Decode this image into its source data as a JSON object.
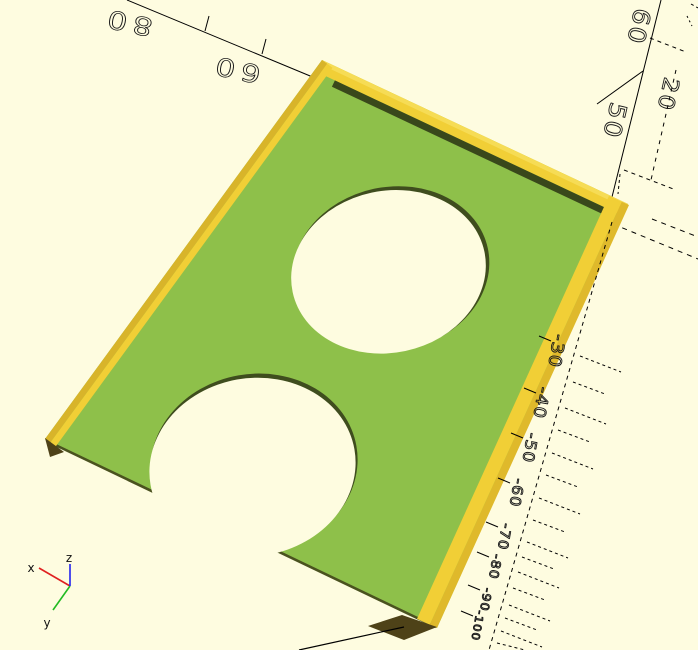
{
  "colors": {
    "background": "#FEFCE0",
    "plate_top": "#8EC04A",
    "wall_top_yellow": "#F1CF36",
    "wall_light_yellow": "#F6DC55",
    "wall_dark_yellow": "#DFB92B",
    "wall_dark_yellow2": "#D8B42A",
    "groove_dark": "#39481B",
    "edge_dark": "#4A521F",
    "hole_rim_dark": "#3F4D1E",
    "end_face_dark": "#4E4218",
    "axis_line": "#000000",
    "nav_x_red": "#E02020",
    "nav_y_green": "#22BB22",
    "nav_z_blue": "#2222EE"
  },
  "axis_labels": {
    "x_axis": [
      {
        "text": "80",
        "x": 129,
        "y": 14
      },
      {
        "text": "60",
        "x": 237,
        "y": 61
      }
    ],
    "z_axis": [
      {
        "text": "60",
        "x": 631,
        "y": 25
      },
      {
        "text": "20",
        "x": 661,
        "y": 93
      },
      {
        "text": "50",
        "x": 607,
        "y": 119
      }
    ],
    "neg_axis": [
      {
        "text": "-30",
        "x": 551,
        "y": 350
      },
      {
        "text": "-40",
        "x": 536,
        "y": 402
      },
      {
        "text": "-50",
        "x": 525,
        "y": 447
      },
      {
        "text": "-60",
        "x": 512,
        "y": 492
      },
      {
        "text": "-70",
        "x": 500,
        "y": 536
      },
      {
        "text": "-80",
        "x": 491,
        "y": 566
      },
      {
        "text": "-90",
        "x": 482,
        "y": 599
      },
      {
        "text": "-100",
        "x": 474,
        "y": 625
      }
    ]
  },
  "nav_cross": {
    "x": "x",
    "y": "y",
    "z": "z"
  }
}
